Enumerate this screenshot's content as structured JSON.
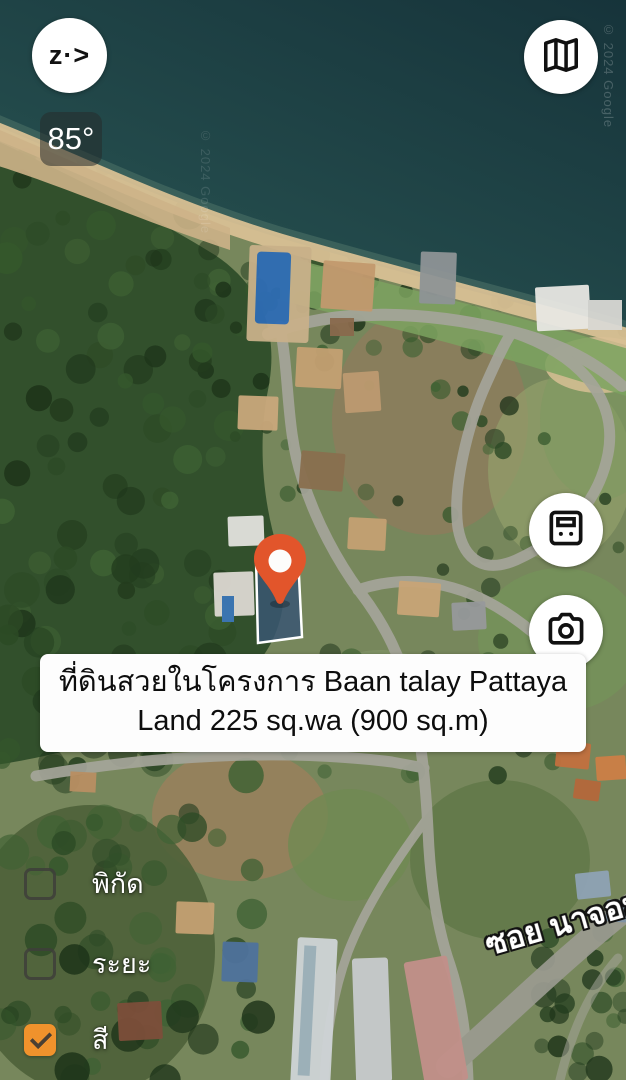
{
  "app": {
    "logo_text": "z·>"
  },
  "hud": {
    "heading": "85°"
  },
  "toolbar": {
    "buttons": [
      {
        "name": "map-style",
        "icon": "folded-map-icon"
      },
      {
        "name": "area-calculator",
        "icon": "calculator-icon"
      },
      {
        "name": "camera",
        "icon": "camera-icon"
      }
    ]
  },
  "listing": {
    "banner_lines": [
      "ที่ดินสวยในโครงการ Baan talay Pattaya",
      "Land 225 sq.wa (900 sq.m)"
    ]
  },
  "map": {
    "road_label": "ซอย นาจอม",
    "watermark": "© 2024 Google",
    "pin_color": "#e2552b",
    "plot_fill": "#3a5670",
    "plot_border": "#ffffff",
    "sea_color": "#1d3c41",
    "sand_color": "#d8c094",
    "road_color": "#a5a59a"
  },
  "layers_panel": {
    "options": [
      {
        "label": "พิกัด",
        "checked": false
      },
      {
        "label": "ระยะ",
        "checked": false
      },
      {
        "label": "สี",
        "checked": true
      }
    ],
    "checked_color": "#f0922c"
  }
}
